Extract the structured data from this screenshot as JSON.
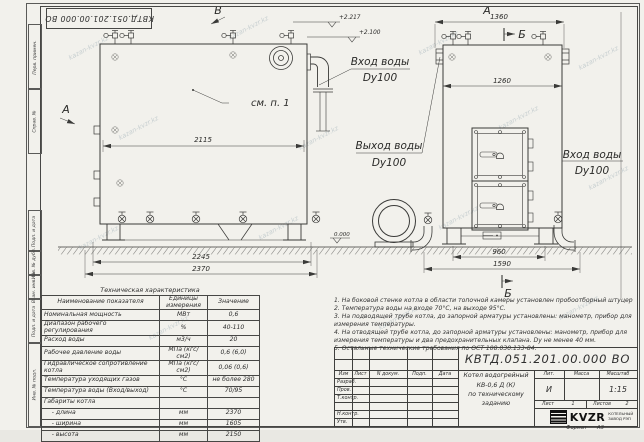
{
  "watermark": {
    "text": "kazan-kvzr.kz"
  },
  "stamp_top": "КВТД.051.201.00.000 ВО",
  "frame": {
    "top_strips": [
      "Перв. примен.",
      "Справ. №"
    ],
    "bottom_strips": [
      "Подп. и дата",
      "Инв. № дубл.",
      "Взам. инв. №",
      "Подп. и дата",
      "Инв. № подл."
    ]
  },
  "views": {
    "front": {
      "label_v": "В",
      "label_a": "А",
      "see_note": "см. п. 1",
      "dim_inner": "2115",
      "dim_legs": "2245",
      "dim_total": "2370",
      "elev_top": "+2.217",
      "elev_mid": "+2.100",
      "ground_elev": "0.000",
      "inlet_line1": "Вход воды",
      "inlet_line2": "Dy100",
      "outlet_line1": "Выход воды",
      "outlet_line2": "Dy100"
    },
    "side": {
      "label_a": "А",
      "label_b_top": "Б",
      "label_b_bottom": "Б",
      "dim_top": "1360",
      "dim_inner": "1260",
      "dim_base": "960",
      "dim_total": "1590",
      "inlet_line1": "Вход воды",
      "inlet_line2": "Dy100"
    }
  },
  "spec_table": {
    "title": "Техническая характеристика",
    "headers": [
      "Наименование показателя",
      "Единицы измерения",
      "Значение"
    ],
    "rows": [
      [
        "Номинальная мощность",
        "МВт",
        "0,6"
      ],
      [
        "Диапазон рабочего регулирования",
        "%",
        "40-110"
      ],
      [
        "Расход воды",
        "м3/ч",
        "20"
      ],
      [
        "Рабочее давление воды",
        "МПа (кгс/см2)",
        "0,6 (6,0)"
      ],
      [
        "Гидравлическое сопротивление котла",
        "МПа (кгс/см2)",
        "0,06 (0,6)"
      ],
      [
        "Температура уходящих газов",
        "°С",
        "не более 280"
      ],
      [
        "Температура воды (Вход/выход)",
        "°С",
        "70/95"
      ],
      [
        "Габариты котла",
        "",
        ""
      ],
      [
        "    - длина",
        "мм",
        "2370"
      ],
      [
        "    - ширина",
        "мм",
        "1605"
      ],
      [
        "    - высота",
        "мм",
        "2150"
      ]
    ]
  },
  "notes": [
    "1.  На боковой стенке котла в области топочной камеры установлен пробоотборный штуцер",
    "2.  Температура воды на входе 70°С, на выходе 95°С.",
    "3.  На подводящей трубе котла, до запорной арматуры установлены: манометр, прибор для измерения температуры.",
    "4.  На отводящей трубе котла, до запорной арматуры установлены: манометр, прибор для измерения температуры и два предохранительных клапана. Dу не менее 40 мм.",
    "5.  Остальные технические требования по ОСТ 108.030.133-84."
  ],
  "title_block": {
    "doc_number": "КВТД.051.201.00.000  ВО",
    "header_cols": [
      "Изм",
      "Лист",
      "N докум.",
      "Подп.",
      "Дата"
    ],
    "row_labels": [
      "Разраб.",
      "Пров.",
      "Т.контр.",
      "Н.контр.",
      "Утв."
    ],
    "product_line1": "Котел водогрейный",
    "product_line2": "КВ-0,6 Д (К)",
    "product_line3": "по техническому заданию",
    "lit_header": "Лит.",
    "mass_header": "Масса",
    "scale_header": "Масштаб",
    "lit_value": "И",
    "scale_value": "1:15",
    "sheet_label": "Лист",
    "sheet_value": "1",
    "sheets_label": "Листов",
    "sheets_value": "2",
    "logo_text": "KVZR",
    "logo_sub1": "КОТЕЛЬНЫЙ",
    "logo_sub2": "ЗАВОД РЭП",
    "format_label": "Формат",
    "format_value": "А3"
  }
}
